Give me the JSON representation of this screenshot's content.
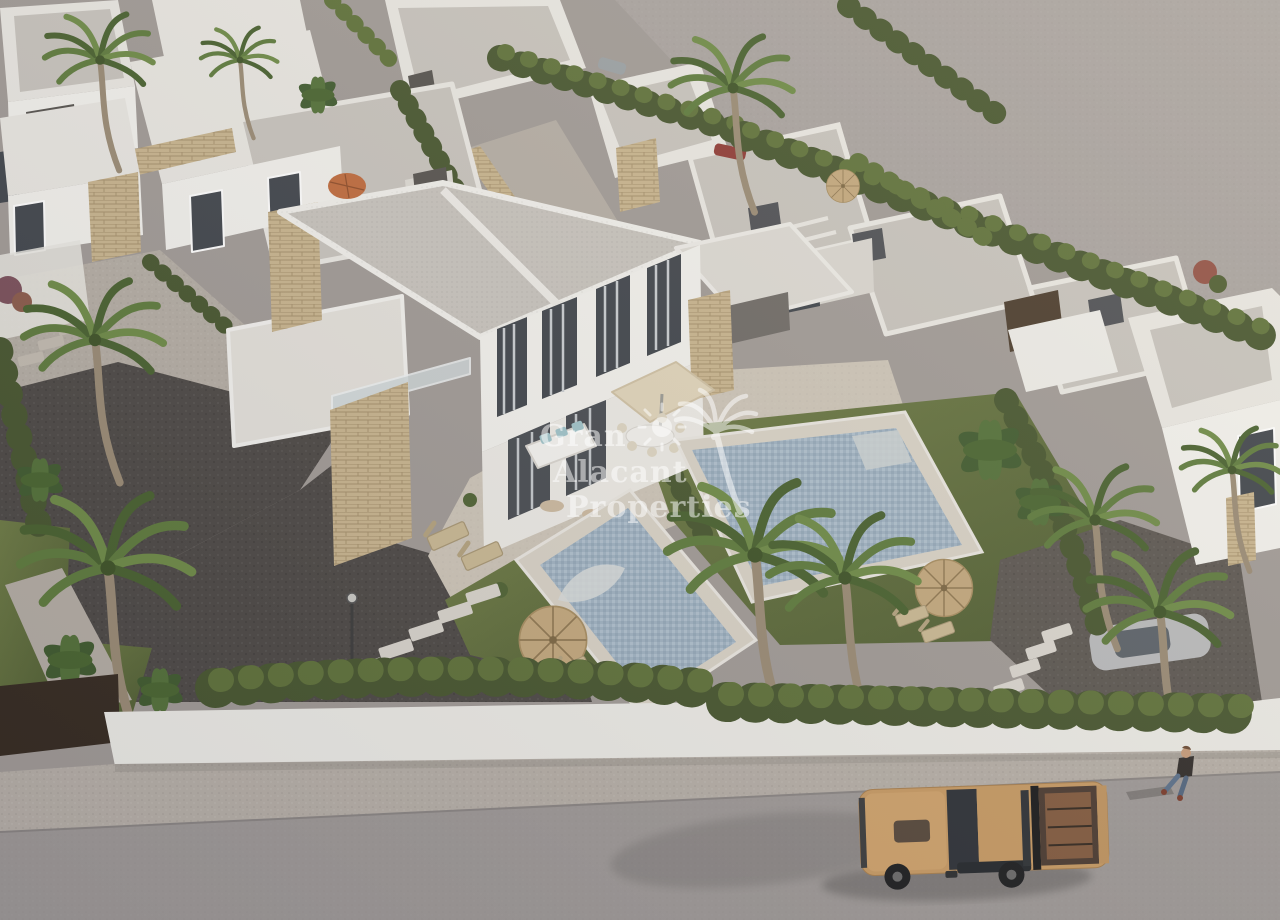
{
  "meta": {
    "type": "3d-architectural-aerial-render",
    "description": "Aerial 3D rendering of a new-build residential development of white modern flat-roof villas with stone-clad accents, private mosaic pools, landscaped gardens with palm trees and straw parasols, bounded by a white wall, gravel sidewalk and asphalt street with a tan pickup truck and a pedestrian. Large empty grey plot at the upper right. Semi-transparent white watermark in the centre."
  },
  "watermark": {
    "line1": "Gran",
    "line2": "Alacant",
    "line3": "Properties",
    "logo": "palm-tree-and-sun-icon",
    "color": "#ffffff",
    "opacity": 0.52
  },
  "scene": {
    "featured_villa": "two-storey semi-detached white villa, grey gravel flat roof with white fascia beams, dark chimney cap, beige stone-clad towers, full-height glazing with grey curtains, glass balustrade, roof terrace",
    "patio": "cream terrace with square cream parasol, outdoor dining table with chairs, white wicker lounge sofa with aqua cushions, two tan sun loungers, potted plants",
    "pools": "two rectangular mosaic-tiled pools with pale stone decks and curved white entry steps",
    "gardens": "lawns with thatched straw parasols and wooden loungers, cypress hedges, fan palms, banana plants, dark gravel driveway with white stepping stones and a street lamp",
    "background": "rows of identical white villas with gravel roofs, dark chimney caps, white pergola slats, beige stone entrance walls, orange parasol, small straw dome parasol, red and silver cars behind hedges, brown boundary fence, large empty grey plot upper right",
    "street": "white boundary wall with continuous hedge, dark brown entrance gate, speckled gravel sidewalk, grey asphalt road",
    "vehicle": "tan double-cab pickup truck with open cargo bed, dark glass and black sport bar",
    "pedestrian": "person in dark jacket and blue jeans walking on the sidewalk, long shadow to the left"
  },
  "palette": {
    "ground": "#a09a96",
    "empty_lot": "#a8a29f",
    "road": "#9e9997",
    "sidewalk": "#b6afa7",
    "wall": "#ecebe6",
    "villa_lit": "#f2f1ed",
    "villa_shade": "#d9d6d0",
    "roof_gravel": "#c7c3bd",
    "roof_white": "#e9e7e2",
    "stone": "#c8b48e",
    "hedge_dark": "#46552e",
    "hedge_light": "#5e7139",
    "lawn_light": "#6d7b44",
    "lawn_dark": "#4e5c31",
    "gravel_dark": "#4c4845",
    "gravel_mid": "#5b5651",
    "path_light": "#b4ada4",
    "pool_water": "#9fb2c2",
    "pool_deck": "#d8d2c6",
    "patio": "#cdc5b8",
    "parasol_straw": "#c3a87d",
    "parasol_orange": "#bf6a3c",
    "parasol_cream": "#e0d4ba",
    "truck_body": "#c79a63",
    "fence_brown": "#43332a",
    "window_dark": "#3f444b",
    "chimney": "#55524e",
    "watermark": "#ffffff"
  }
}
